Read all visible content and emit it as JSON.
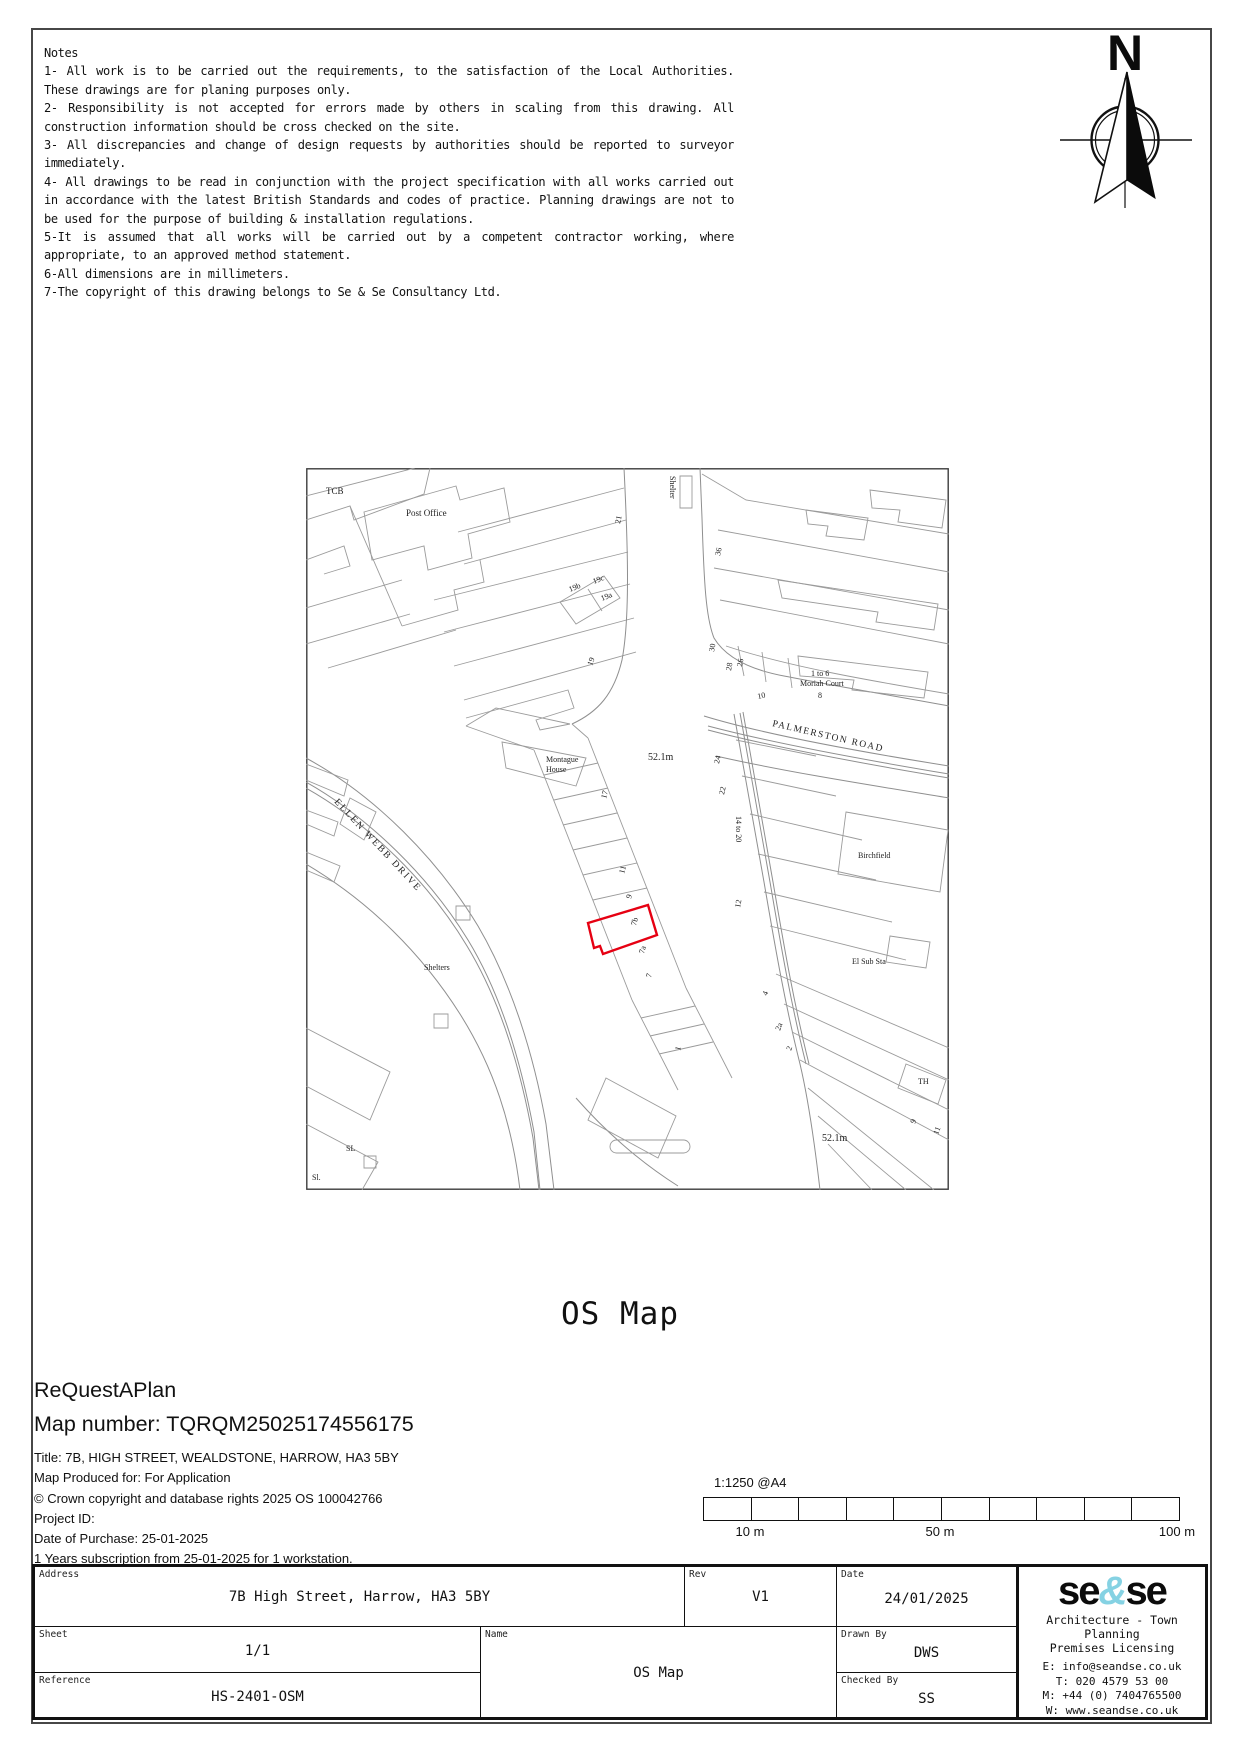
{
  "notes": {
    "title": "Notes",
    "lines": [
      "1- All work is to be carried out the requirements, to the satisfaction of the Local Authorities. These drawings are for planing purposes only.",
      "2- Responsibility is not accepted for errors made by others in scaling from this drawing. All construction information should be cross checked on the site.",
      "3- All discrepancies and change of design requests by authorities should be reported to surveyor immediately.",
      "4- All drawings to be read in conjunction with the project specification with all works carried out in accordance with the latest British Standards and codes of practice. Planning drawings are not to be used for the purpose of building & installation regulations.",
      "5-It is assumed that all works will be carried out by a competent contractor working, where appropriate, to an approved method statement.",
      "6-All dimensions are in millimeters.",
      "7-The copyright of this drawing belongs to Se & Se Consultancy Ltd."
    ]
  },
  "compass": {
    "north_label": "N"
  },
  "map": {
    "site_outline_color": "#e60012",
    "labels": [
      {
        "text": "TCB",
        "x": 20,
        "y": 26,
        "size": 9
      },
      {
        "text": "Post Office",
        "x": 100,
        "y": 48,
        "size": 9
      },
      {
        "text": "Shelter",
        "x": 364,
        "y": 8,
        "size": 8,
        "rotate": 90
      },
      {
        "text": "21",
        "x": 314,
        "y": 56,
        "size": 8,
        "rotate": -78
      },
      {
        "text": "36",
        "x": 414,
        "y": 88,
        "size": 8,
        "rotate": -78
      },
      {
        "text": "19b",
        "x": 264,
        "y": 124,
        "size": 8,
        "rotate": -22
      },
      {
        "text": "19c",
        "x": 288,
        "y": 116,
        "size": 8,
        "rotate": -22
      },
      {
        "text": "19a",
        "x": 296,
        "y": 133,
        "size": 8,
        "rotate": -22
      },
      {
        "text": "19",
        "x": 286,
        "y": 198,
        "size": 8,
        "rotate": -70
      },
      {
        "text": "30",
        "x": 408,
        "y": 184,
        "size": 8,
        "rotate": -80
      },
      {
        "text": "28",
        "x": 425,
        "y": 203,
        "size": 8,
        "rotate": -80
      },
      {
        "text": "26",
        "x": 436,
        "y": 199,
        "size": 8,
        "rotate": -80
      },
      {
        "text": "1 to 6",
        "x": 505,
        "y": 208,
        "size": 8
      },
      {
        "text": "Moriah Court",
        "x": 494,
        "y": 218,
        "size": 8
      },
      {
        "text": "10",
        "x": 452,
        "y": 231,
        "size": 8,
        "rotate": -12
      },
      {
        "text": "8",
        "x": 512,
        "y": 230,
        "size": 8
      },
      {
        "text": "PALMERSTON ROAD",
        "x": 466,
        "y": 258,
        "size": 9.5,
        "rotate": 13,
        "spacing": 1.5
      },
      {
        "text": "52.1m",
        "x": 342,
        "y": 292,
        "size": 10
      },
      {
        "text": "Montague",
        "x": 240,
        "y": 294,
        "size": 8
      },
      {
        "text": "House",
        "x": 240,
        "y": 304,
        "size": 8
      },
      {
        "text": "24",
        "x": 413,
        "y": 296,
        "size": 8,
        "rotate": -78
      },
      {
        "text": "22",
        "x": 418,
        "y": 327,
        "size": 8,
        "rotate": -78
      },
      {
        "text": "14 to 20",
        "x": 430,
        "y": 348,
        "size": 8,
        "rotate": 90
      },
      {
        "text": "12",
        "x": 434,
        "y": 440,
        "size": 8,
        "rotate": -80
      },
      {
        "text": "17",
        "x": 300,
        "y": 331,
        "size": 8,
        "rotate": -75
      },
      {
        "text": "11",
        "x": 318,
        "y": 406,
        "size": 8,
        "rotate": -75
      },
      {
        "text": "9",
        "x": 325,
        "y": 431,
        "size": 8,
        "rotate": -75
      },
      {
        "text": "7b",
        "x": 330,
        "y": 458,
        "size": 8,
        "rotate": -75
      },
      {
        "text": "7a",
        "x": 338,
        "y": 486,
        "size": 8,
        "rotate": -75
      },
      {
        "text": "7",
        "x": 345,
        "y": 510,
        "size": 8,
        "rotate": -75
      },
      {
        "text": "1",
        "x": 374,
        "y": 583,
        "size": 8,
        "rotate": -75
      },
      {
        "text": "Birchfield",
        "x": 552,
        "y": 390,
        "size": 8
      },
      {
        "text": "El Sub Sta",
        "x": 546,
        "y": 496,
        "size": 8
      },
      {
        "text": "ELLEN WEBB DRIVE",
        "x": 28,
        "y": 334,
        "size": 9.5,
        "rotate": 47,
        "spacing": 2
      },
      {
        "text": "Shelters",
        "x": 118,
        "y": 502,
        "size": 8
      },
      {
        "text": "4",
        "x": 461,
        "y": 528,
        "size": 8,
        "rotate": -70
      },
      {
        "text": "2a",
        "x": 474,
        "y": 563,
        "size": 8,
        "rotate": -70
      },
      {
        "text": "2",
        "x": 485,
        "y": 583,
        "size": 8,
        "rotate": -70
      },
      {
        "text": "TH",
        "x": 612,
        "y": 616,
        "size": 8
      },
      {
        "text": "9",
        "x": 609,
        "y": 656,
        "size": 8,
        "rotate": -70
      },
      {
        "text": "11",
        "x": 632,
        "y": 667,
        "size": 8,
        "rotate": -70
      },
      {
        "text": "52.1m",
        "x": 516,
        "y": 673,
        "size": 10
      },
      {
        "text": "SL",
        "x": 40,
        "y": 683,
        "size": 8
      },
      {
        "text": "Sl.",
        "x": 6,
        "y": 712,
        "size": 8
      }
    ]
  },
  "heading": {
    "title": "OS Map"
  },
  "map_info": {
    "provider": "ReQuestAPlan",
    "map_number": "Map number: TQRQM25025174556175",
    "title_line": "Title: 7B, HIGH STREET, WEALDSTONE, HARROW, HA3 5BY",
    "produced_for": "Map Produced for: For Application",
    "copyright": "© Crown copyright and database rights 2025 OS 100042766",
    "project_id": "Project ID:",
    "purchase_date": "Date of Purchase: 25-01-2025",
    "subscription": "1 Years subscription from 25-01-2025 for 1 workstation."
  },
  "scale_bar": {
    "ratio": "1:1250 @A4",
    "segments": 10,
    "tick_10": "10 m",
    "tick_50": "50 m",
    "tick_100": "100 m"
  },
  "title_block": {
    "address_label": "Address",
    "address": "7B High Street, Harrow, HA3 5BY",
    "rev_label": "Rev",
    "rev": "V1",
    "date_label": "Date",
    "date": "24/01/2025",
    "sheet_label": "Sheet",
    "sheet": "1/1",
    "name_label": "Name",
    "name": "OS Map",
    "drawn_label": "Drawn By",
    "drawn": "DWS",
    "checked_label": "Checked By",
    "checked": "SS",
    "reference_label": "Reference",
    "reference": "HS-2401-OSM",
    "logo": {
      "part1": "se",
      "amp": "&",
      "part2": "se",
      "accent": "#85d2e3",
      "tagline1": "Architecture - Town Planning",
      "tagline2": "Premises Licensing",
      "email": "E: info@seandse.co.uk",
      "tel": "T: 020 4579 53 00",
      "mobile": "M: +44 (0) 7404765500",
      "web": "W: www.seandse.co.uk"
    }
  }
}
